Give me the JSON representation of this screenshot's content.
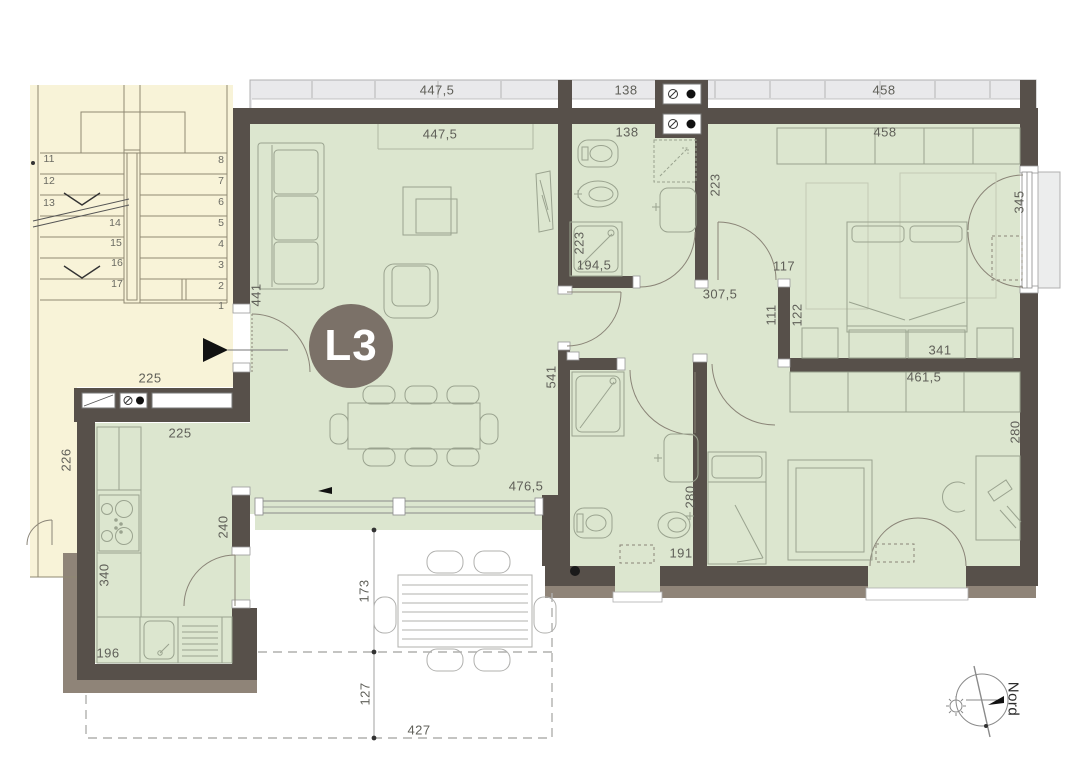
{
  "unit": {
    "label": "L3"
  },
  "compass": {
    "label": "Nord"
  },
  "colors": {
    "wall": "#57504a",
    "wall_light": "#8f8478",
    "room_fill": "#dce6cf",
    "stairwell_fill": "#f8f3d8",
    "balcony_fill": "#e9e9eb",
    "badge_fill": "#7b7168",
    "badge_text": "#ffffff",
    "dimension_text": "#5f5f58"
  },
  "dimensions": [
    {
      "text": "447,5",
      "x": 437,
      "y": 90
    },
    {
      "text": "138",
      "x": 626,
      "y": 90
    },
    {
      "text": "458",
      "x": 884,
      "y": 90
    },
    {
      "text": "447,5",
      "x": 440,
      "y": 134
    },
    {
      "text": "138",
      "x": 627,
      "y": 132
    },
    {
      "text": "458",
      "x": 885,
      "y": 132
    },
    {
      "text": "441",
      "x": 256,
      "y": 295,
      "rot": true
    },
    {
      "text": "223",
      "x": 579,
      "y": 243,
      "rot": true
    },
    {
      "text": "194,5",
      "x": 594,
      "y": 265
    },
    {
      "text": "223",
      "x": 715,
      "y": 185,
      "rot": true
    },
    {
      "text": "345",
      "x": 1019,
      "y": 202,
      "rot": true
    },
    {
      "text": "117",
      "x": 784,
      "y": 266
    },
    {
      "text": "307,5",
      "x": 720,
      "y": 294
    },
    {
      "text": "111",
      "x": 771,
      "y": 315,
      "rot": true
    },
    {
      "text": "122",
      "x": 797,
      "y": 315,
      "rot": true
    },
    {
      "text": "341",
      "x": 940,
      "y": 350
    },
    {
      "text": "461,5",
      "x": 924,
      "y": 377
    },
    {
      "text": "541",
      "x": 551,
      "y": 377,
      "rot": true
    },
    {
      "text": "280",
      "x": 690,
      "y": 497,
      "rot": true
    },
    {
      "text": "191",
      "x": 681,
      "y": 553
    },
    {
      "text": "280",
      "x": 1015,
      "y": 432,
      "rot": true
    },
    {
      "text": "476,5",
      "x": 526,
      "y": 486
    },
    {
      "text": "225",
      "x": 150,
      "y": 378
    },
    {
      "text": "225",
      "x": 180,
      "y": 433
    },
    {
      "text": "226",
      "x": 66,
      "y": 460,
      "rot": true
    },
    {
      "text": "340",
      "x": 104,
      "y": 575,
      "rot": true
    },
    {
      "text": "240",
      "x": 223,
      "y": 527,
      "rot": true
    },
    {
      "text": "196",
      "x": 108,
      "y": 653
    },
    {
      "text": "173",
      "x": 364,
      "y": 591,
      "rot": true
    },
    {
      "text": "127",
      "x": 365,
      "y": 694,
      "rot": true
    },
    {
      "text": "427",
      "x": 419,
      "y": 730
    }
  ],
  "stair_numbers": [
    {
      "text": "11",
      "x": 49,
      "y": 159
    },
    {
      "text": "12",
      "x": 49,
      "y": 181
    },
    {
      "text": "13",
      "x": 49,
      "y": 203
    },
    {
      "text": "14",
      "x": 115,
      "y": 223
    },
    {
      "text": "15",
      "x": 116,
      "y": 243
    },
    {
      "text": "16",
      "x": 117,
      "y": 263
    },
    {
      "text": "17",
      "x": 117,
      "y": 284
    },
    {
      "text": "8",
      "x": 221,
      "y": 160
    },
    {
      "text": "7",
      "x": 221,
      "y": 181
    },
    {
      "text": "6",
      "x": 221,
      "y": 202
    },
    {
      "text": "5",
      "x": 221,
      "y": 223
    },
    {
      "text": "4",
      "x": 221,
      "y": 244
    },
    {
      "text": "3",
      "x": 221,
      "y": 265
    },
    {
      "text": "2",
      "x": 221,
      "y": 286
    },
    {
      "text": "1",
      "x": 221,
      "y": 306
    }
  ]
}
